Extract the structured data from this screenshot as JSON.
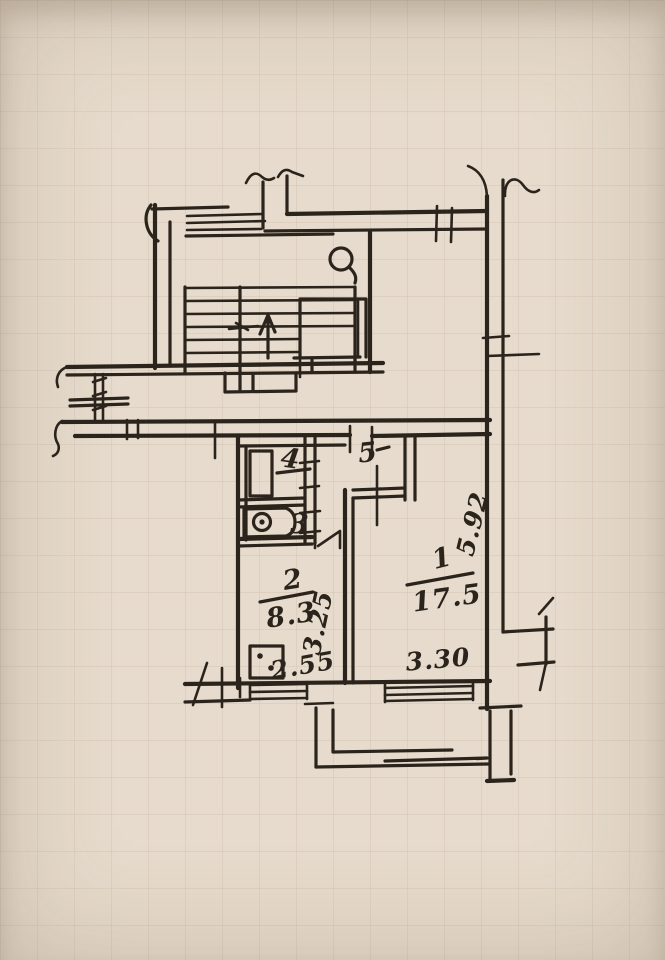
{
  "document": {
    "kind": "hand-drawn apartment floor plan sketch"
  },
  "colors": {
    "paper": "#e6dbcc",
    "ink": "#2b241c",
    "grid": "rgba(164,136,112,0.12)"
  },
  "rooms": {
    "room1": {
      "number": "1",
      "area": "17.5"
    },
    "room2": {
      "number": "2",
      "area": "8.3"
    },
    "room3": {
      "number": "3"
    },
    "room4": {
      "number": "4"
    },
    "room5": {
      "number": "5"
    }
  },
  "dimensions": {
    "kitchen_width": "2.55",
    "kitchen_depth": "3.25",
    "room1_width": "3.30",
    "room1_wall_depth": "5.92"
  }
}
